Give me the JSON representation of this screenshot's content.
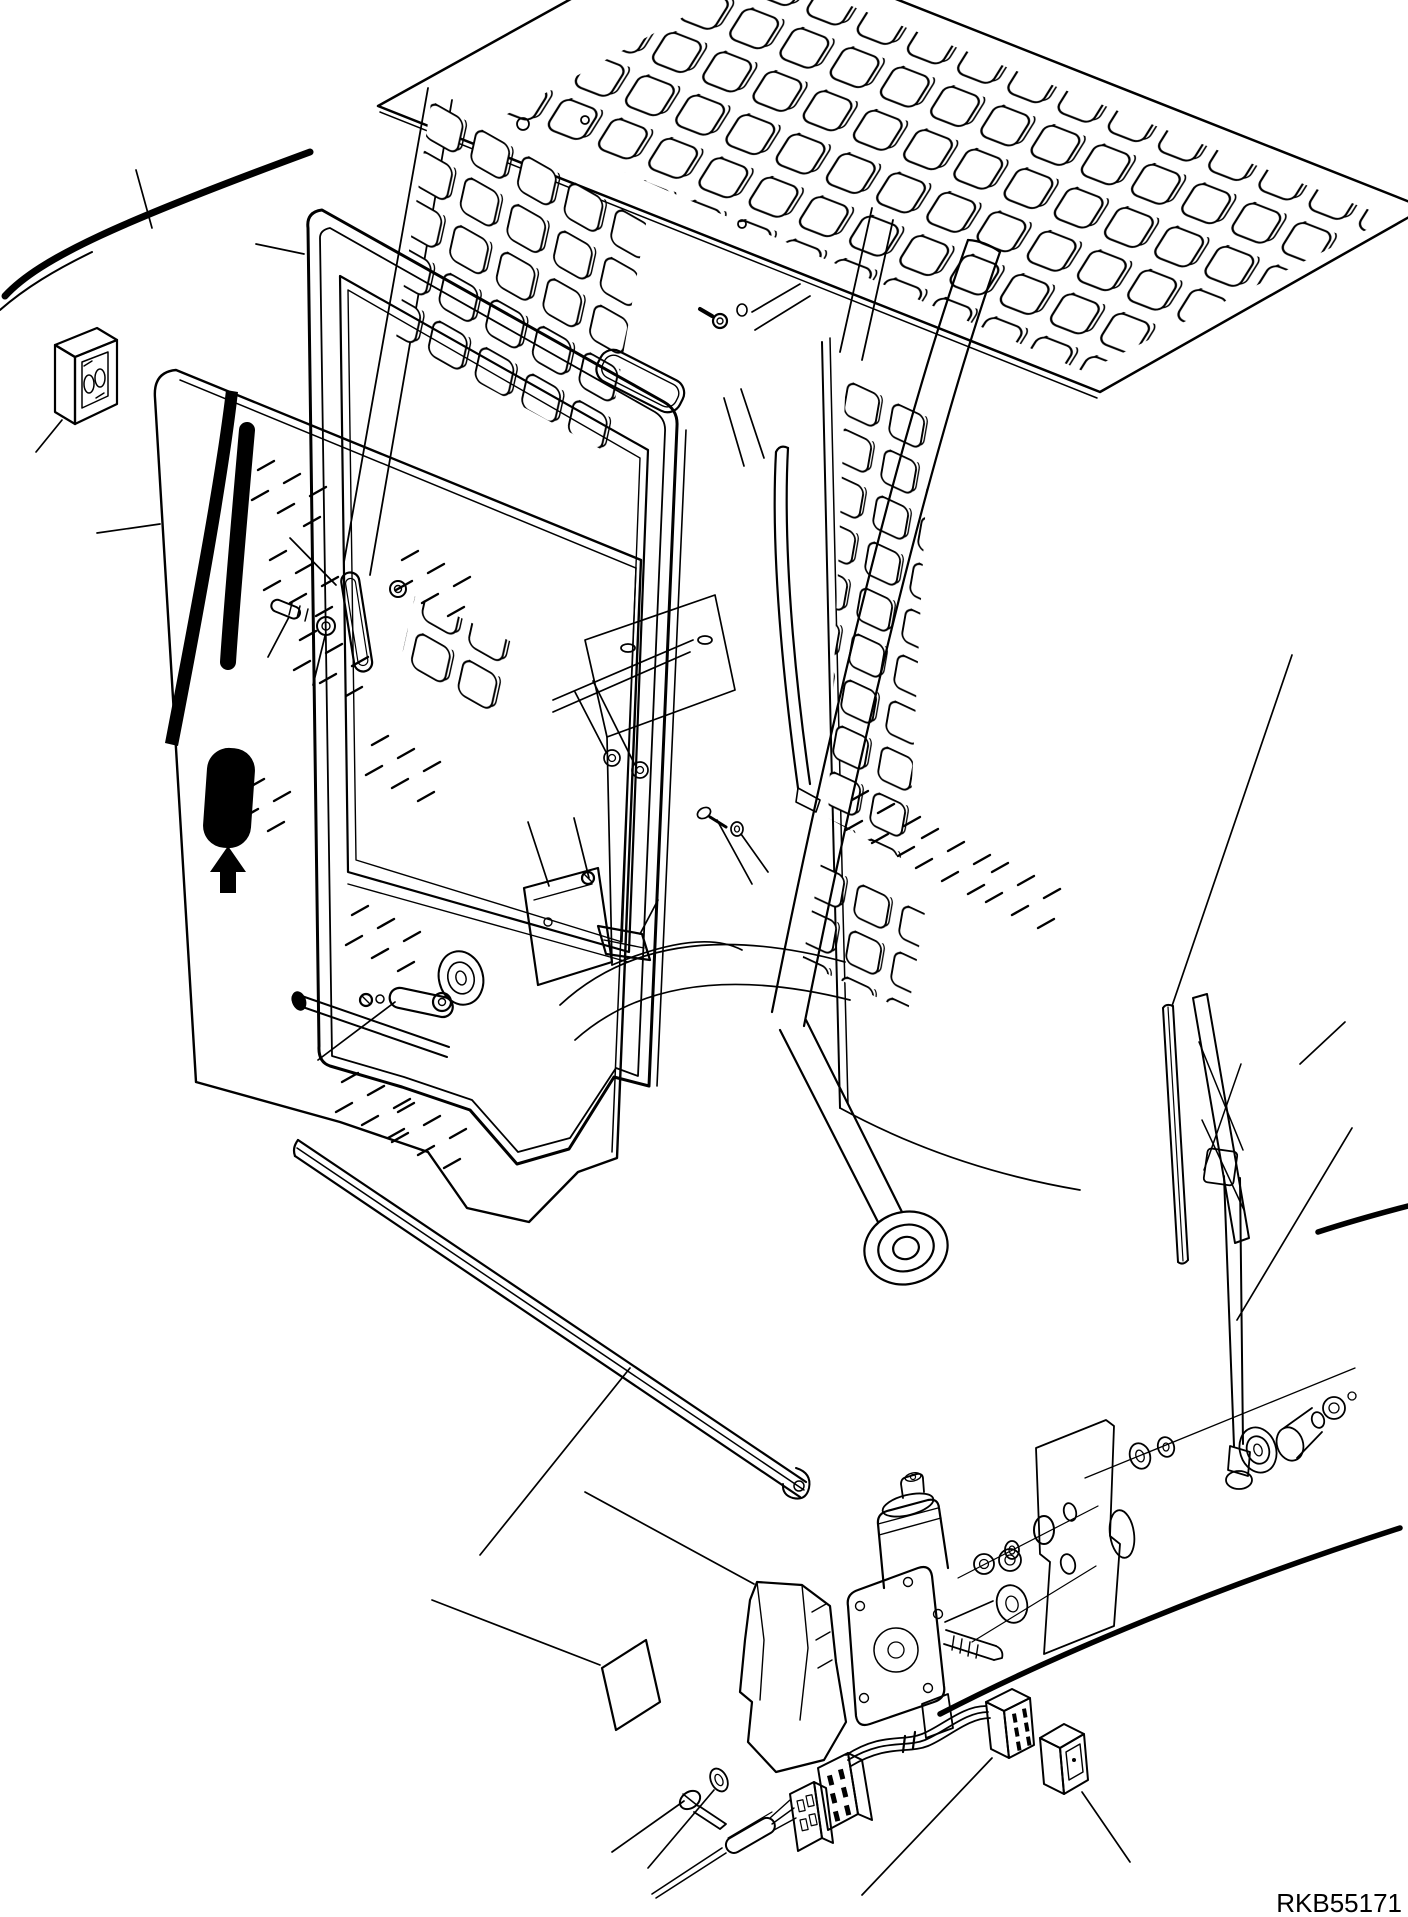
{
  "figure": {
    "code": "RKB55171",
    "type": "exploded-parts-diagram",
    "subject": "cab door, window glass and wiper assembly",
    "colors": {
      "line": "#000000",
      "background": "#ffffff",
      "decal_fill": "#000000"
    }
  },
  "parts": [
    "cab-left-edge",
    "cab-roof-guard-panel",
    "door-striker-block",
    "rear-screen-panel",
    "roof-mounting-bracket",
    "cab-interior-structure",
    "door-frame",
    "door-frame-handle",
    "door-lock-assembly",
    "door-glass",
    "door-handle-decal",
    "glass-hatching",
    "screw-and-nut-fasteners",
    "window-latch-lever",
    "glass-run-strip",
    "lower-trim-rail",
    "cab-right-side",
    "front-pillar",
    "pillar-roller",
    "grab-rail",
    "wiper-rubber",
    "wiper-blade",
    "wiper-arm",
    "wiper-pivot-hardware",
    "cutaway-mounting-panel",
    "washers-nuts-orings",
    "identification-plate",
    "wiper-motor-cover",
    "wiper-motor",
    "motor-shaft",
    "mounting-screw",
    "grommet",
    "cable-sleeve",
    "wire-connectors",
    "wiring-harness",
    "harness-connector",
    "rocker-switch",
    "leader-lines",
    "drawing-code"
  ]
}
